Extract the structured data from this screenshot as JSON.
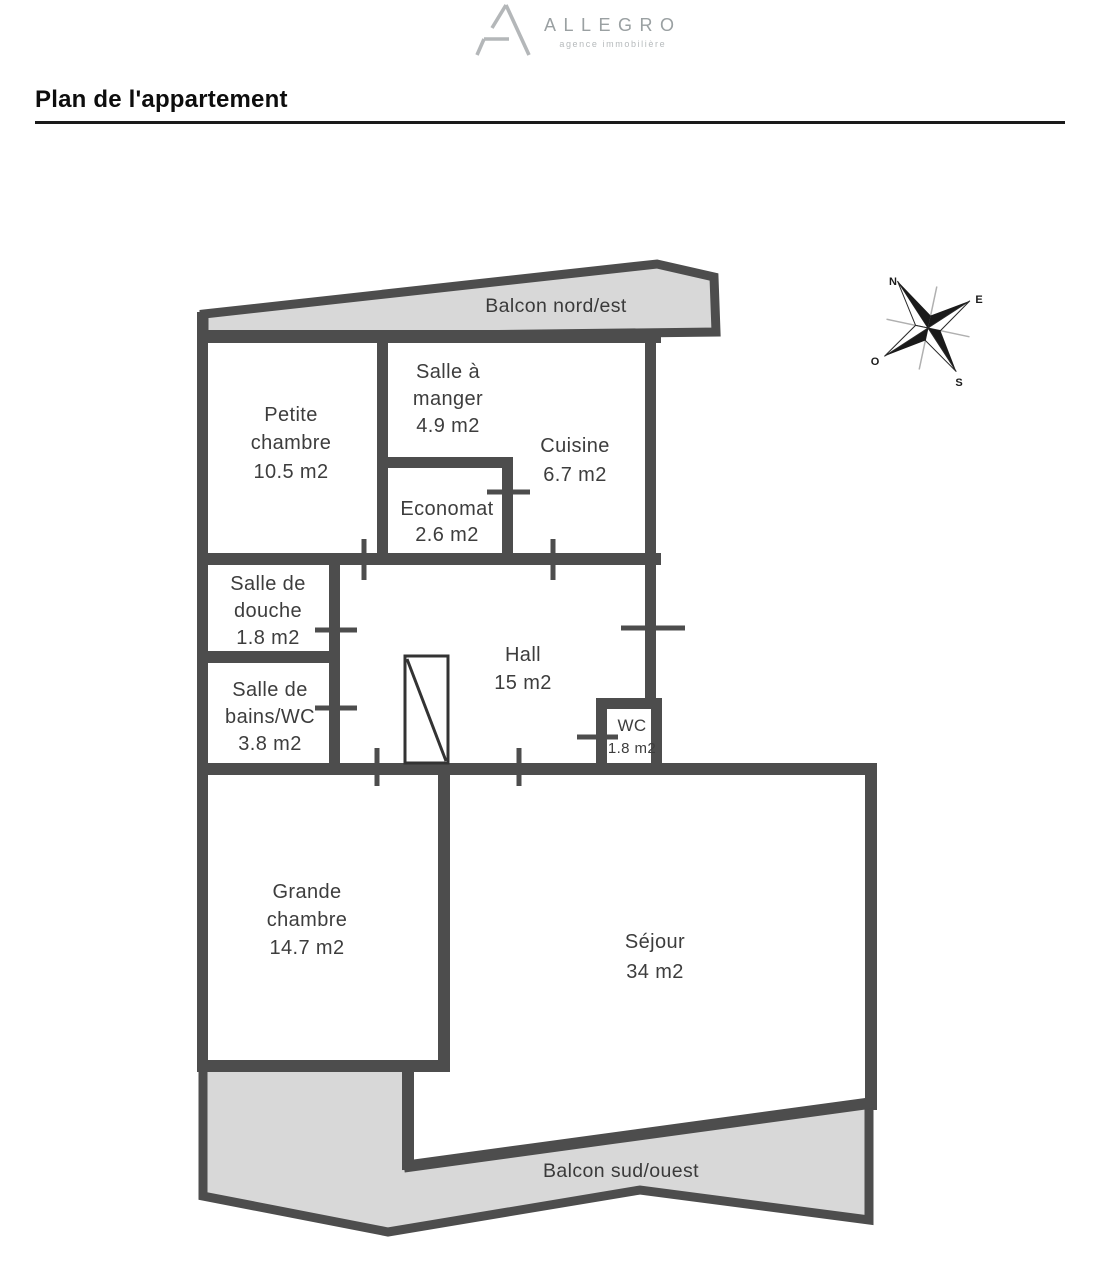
{
  "logo": {
    "brand": "ALLEGRO",
    "tagline": "agence immobilière"
  },
  "header": {
    "title": "Plan de l'appartement"
  },
  "compass": {
    "north": "N",
    "east": "E",
    "south": "S",
    "west": "O"
  },
  "plan": {
    "balcony_north": "Balcon nord/est",
    "balcony_south": "Balcon sud/ouest",
    "rooms": [
      {
        "id": "petite-chambre",
        "label_lines": [
          "Petite",
          "chambre"
        ],
        "area": "10.5 m2"
      },
      {
        "id": "salle-a-manger",
        "label_lines": [
          "Salle à",
          "manger"
        ],
        "area": "4.9 m2"
      },
      {
        "id": "cuisine",
        "label_lines": [
          "Cuisine"
        ],
        "area": "6.7 m2"
      },
      {
        "id": "economat",
        "label_lines": [
          "Economat"
        ],
        "area": "2.6 m2"
      },
      {
        "id": "salle-de-douche",
        "label_lines": [
          "Salle de",
          "douche"
        ],
        "area": "1.8 m2"
      },
      {
        "id": "salle-de-bains-wc",
        "label_lines": [
          "Salle de",
          "bains/WC"
        ],
        "area": "3.8 m2"
      },
      {
        "id": "hall",
        "label_lines": [
          "Hall"
        ],
        "area": "15 m2"
      },
      {
        "id": "wc",
        "label_lines": [
          "WC"
        ],
        "area": "1.8 m2"
      },
      {
        "id": "grande-chambre",
        "label_lines": [
          "Grande",
          "chambre"
        ],
        "area": "14.7 m2"
      },
      {
        "id": "sejour",
        "label_lines": [
          "Séjour"
        ],
        "area": "34 m2"
      }
    ]
  },
  "colors": {
    "wall": "#4d4d4d",
    "balcony_fill": "#d8d8d8",
    "label_text": "#3d3d3d",
    "logo_gray": "#9aa0a2"
  }
}
